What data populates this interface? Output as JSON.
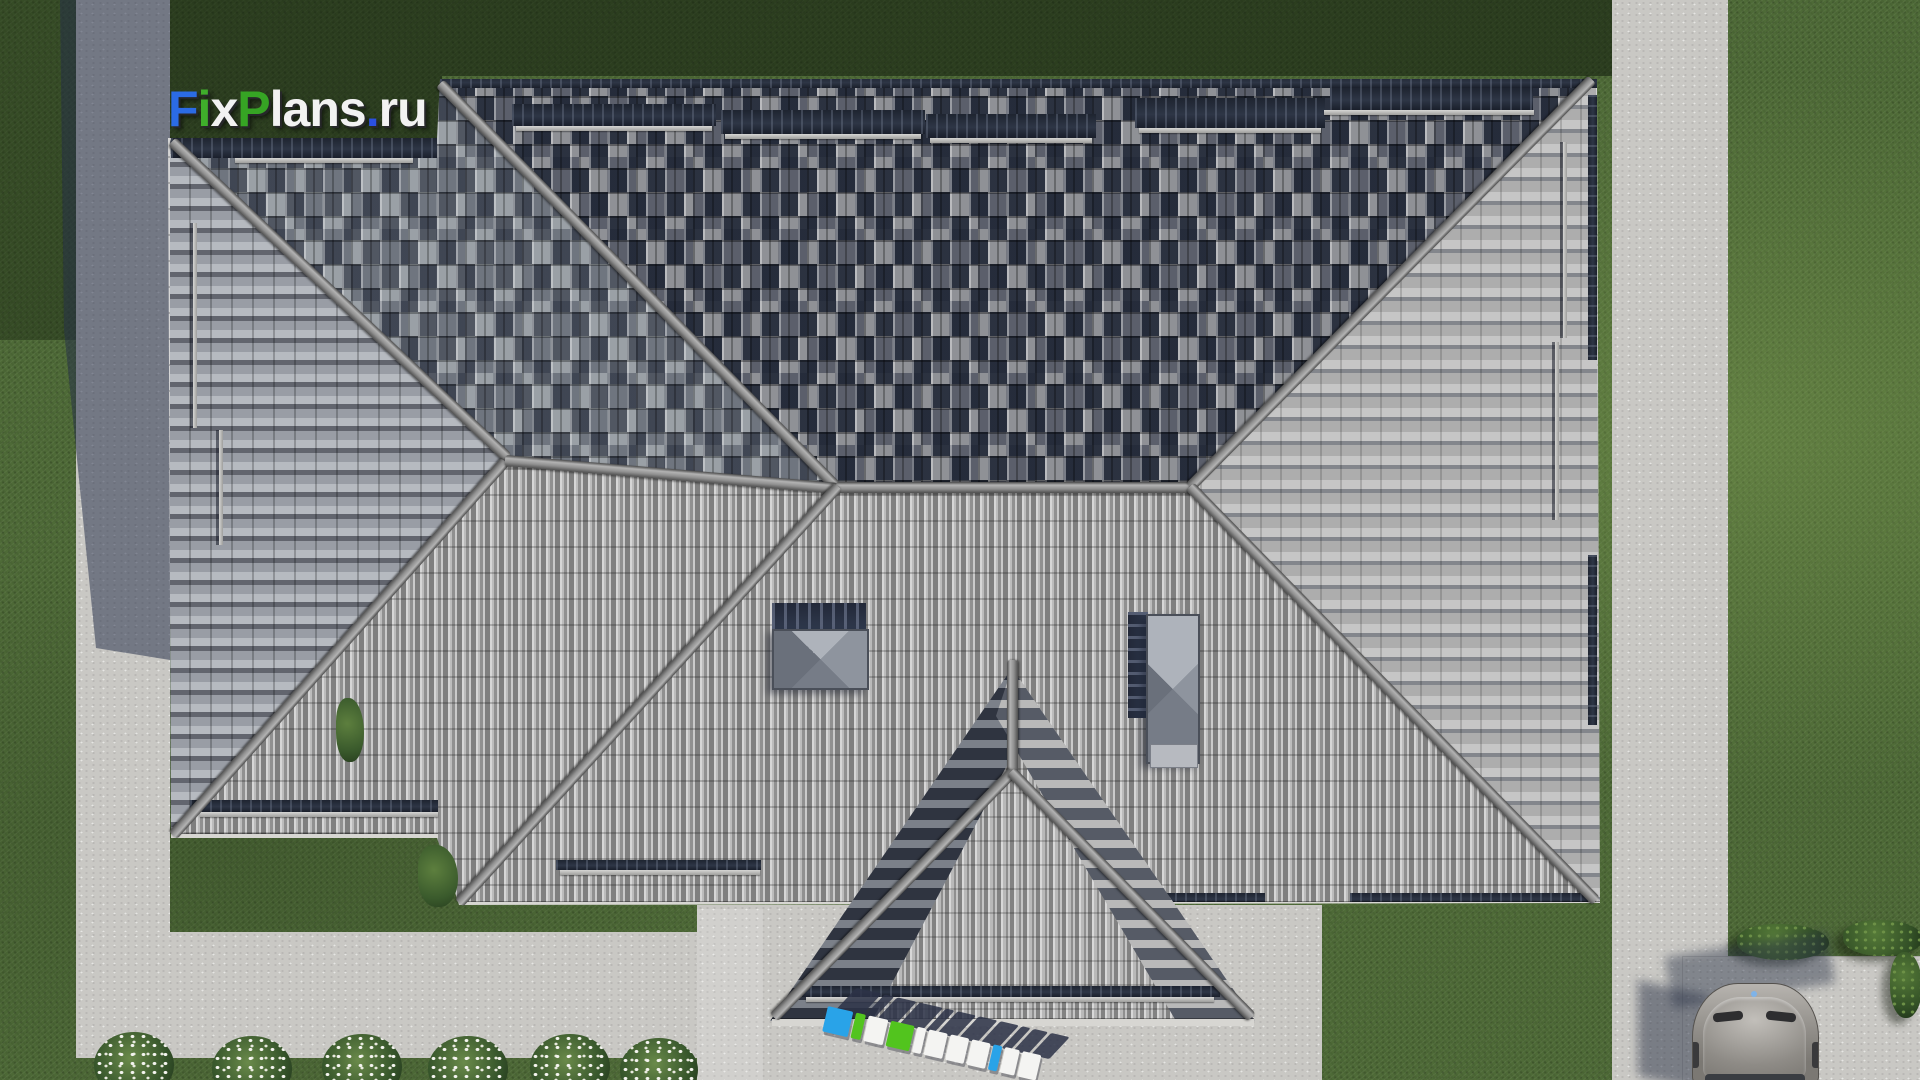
{
  "watermark": {
    "text": "FixPlans.ru",
    "letters": [
      {
        "ch": "F",
        "color": "#2b6be5"
      },
      {
        "ch": "i",
        "color": "#3fae2b"
      },
      {
        "ch": "x",
        "color": "#f2f2f2"
      },
      {
        "ch": "P",
        "color": "#36a424"
      },
      {
        "ch": "l",
        "color": "#f2f2f2"
      },
      {
        "ch": "a",
        "color": "#f2f2f2"
      },
      {
        "ch": "n",
        "color": "#f2f2f2"
      },
      {
        "ch": "s",
        "color": "#f2f2f2"
      },
      {
        "ch": ".",
        "color": "#2b50e0"
      },
      {
        "ch": "r",
        "color": "#f2f2f2"
      },
      {
        "ch": "u",
        "color": "#f2f2f2"
      }
    ]
  },
  "ground_logo": {
    "text": "FixPlans.ru",
    "letters": [
      {
        "ch": "F",
        "color": "#29a3e8"
      },
      {
        "ch": "i",
        "color": "#52c41e"
      },
      {
        "ch": "x",
        "color": "#f4f4f2"
      },
      {
        "ch": "P",
        "color": "#52c41e"
      },
      {
        "ch": "l",
        "color": "#f4f4f2"
      },
      {
        "ch": "a",
        "color": "#f4f4f2"
      },
      {
        "ch": "n",
        "color": "#f4f4f2"
      },
      {
        "ch": "s",
        "color": "#f4f4f2"
      },
      {
        "ch": ".",
        "color": "#29a3e8"
      },
      {
        "ch": "r",
        "color": "#f4f4f2"
      },
      {
        "ch": "u",
        "color": "#f4f4f2"
      }
    ],
    "shadow_color": "#2c3247"
  },
  "scene": {
    "view": "top-down aerial render of hipped-roof house",
    "objects": [
      "house-roof",
      "roof-vents",
      "lawn",
      "walkways",
      "patio-driveway",
      "car",
      "car-pad",
      "flower-bushes",
      "shrubs"
    ],
    "colors": {
      "grass": "#4e6a37",
      "grass_shaded": "#2c3d24",
      "pavement": "#c9c8c4",
      "roof_tile_light": "#bcbcbc",
      "roof_tile_dark": "#2e3646",
      "ridge": "#9a9a9a",
      "shadow": "#252e48",
      "car_body": "#928f8a"
    }
  }
}
